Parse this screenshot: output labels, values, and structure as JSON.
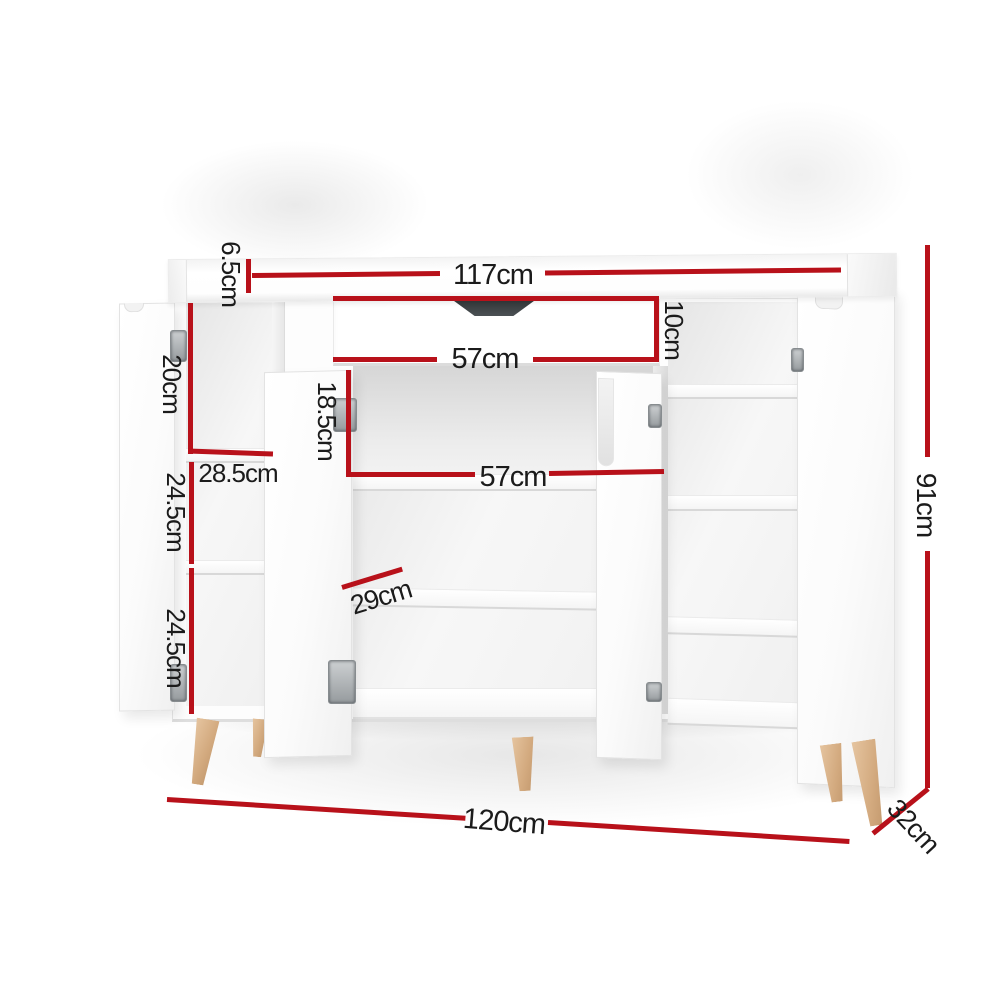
{
  "diagram": {
    "subject": "shoe cabinet dimension diagram",
    "colors": {
      "dimension_line": "#b8111a",
      "label_text": "#1b1b1b",
      "cabinet": "#ffffff",
      "wood_leg": "#d3aa7f",
      "drawer_handle": "#32373a"
    },
    "labels": {
      "top_panel_thickness": "6.5cm",
      "top_width": "117cm",
      "drawer_width": "57cm",
      "drawer_height": "10cm",
      "left_top_compartment": "20cm",
      "left_inner_width": "28.5cm",
      "left_middle_compartment": "24.5cm",
      "left_bottom_compartment": "24.5cm",
      "middle_top_compartment": "18.5cm",
      "middle_inner_width": "57cm",
      "shelf_depth": "29cm",
      "overall_height": "91cm",
      "overall_width": "120cm",
      "overall_depth": "32cm"
    }
  }
}
